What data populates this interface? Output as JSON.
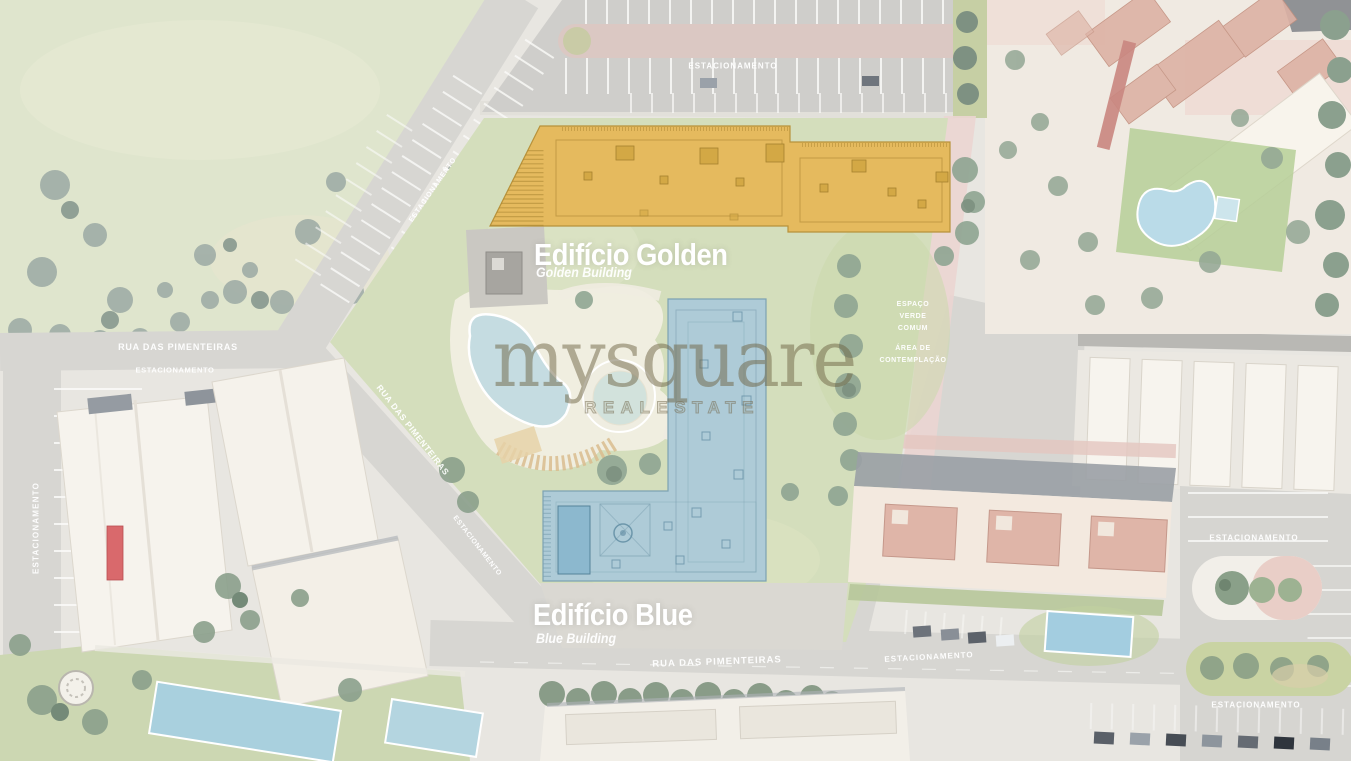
{
  "watermark": {
    "brand": "mysquare",
    "tagline": "REALESTATE"
  },
  "buildings": {
    "golden": {
      "title": "Edifício Golden",
      "subtitle": "Golden Building",
      "color": "#e5ba5e"
    },
    "blue": {
      "title": "Edifício Blue",
      "subtitle": "Blue Building",
      "color": "#aecbd7"
    }
  },
  "zones": {
    "green_space": "ESPAÇO\nVERDE\nCOMUM",
    "contemplation": "ÁREA DE\nCONTEMPLAÇÃO"
  },
  "roads": {
    "street_name": "RUA DAS PIMENTEIRAS",
    "parking_label": "ESTACIONAMENTO"
  }
}
